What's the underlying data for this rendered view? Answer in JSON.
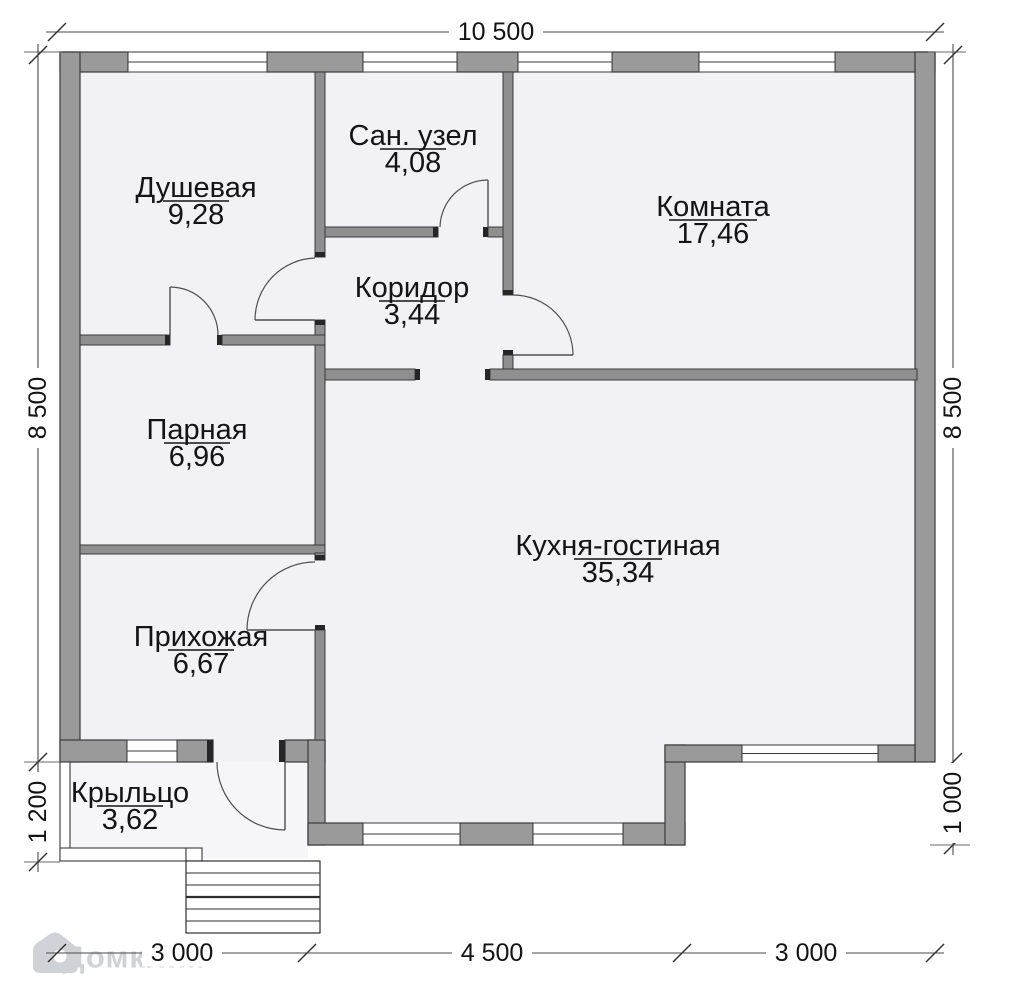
{
  "palette": {
    "background": "#ffffff",
    "room_fill": "#f1f1f6",
    "porch_fill": "#f6f6fa",
    "wall_ext_fill": "#9a9a9a",
    "wall_int_fill": "#8f8f8f",
    "wall_outline": "#3a3a3a",
    "cap_fill": "#262626",
    "door_line": "#4f4f4f",
    "dim_line": "#4a4a4a",
    "text_color": "#141414",
    "watermark_color": "#979da8"
  },
  "plan": {
    "footprint": [
      {
        "x": 60,
        "y": 52,
        "w": 875,
        "h": 710,
        "kind": "room"
      },
      {
        "x": 308,
        "y": 762,
        "w": 377,
        "h": 83,
        "kind": "room"
      },
      {
        "x": 62,
        "y": 762,
        "w": 246,
        "h": 96,
        "kind": "porch"
      }
    ],
    "walls_ext": [
      [
        60,
        52,
        68,
        20
      ],
      [
        267,
        52,
        96,
        20
      ],
      [
        457,
        52,
        61,
        20
      ],
      [
        612,
        52,
        87,
        20
      ],
      [
        835,
        52,
        100,
        20
      ],
      [
        60,
        52,
        20,
        710
      ],
      [
        915,
        52,
        20,
        710
      ],
      [
        60,
        740,
        67,
        22
      ],
      [
        177,
        740,
        36,
        22
      ],
      [
        285,
        740,
        40,
        22
      ],
      [
        308,
        740,
        17,
        105
      ],
      [
        308,
        823,
        55,
        22
      ],
      [
        460,
        823,
        73,
        22
      ],
      [
        623,
        823,
        62,
        22
      ],
      [
        665,
        745,
        20,
        100
      ],
      [
        665,
        745,
        77,
        17
      ],
      [
        878,
        745,
        37,
        17
      ]
    ],
    "walls_int": [
      [
        315,
        72,
        10,
        185
      ],
      [
        315,
        320,
        10,
        233
      ],
      [
        325,
        227,
        113,
        10
      ],
      [
        488,
        227,
        15,
        10
      ],
      [
        503,
        72,
        10,
        223
      ],
      [
        503,
        355,
        10,
        25
      ],
      [
        80,
        335,
        90,
        10
      ],
      [
        222,
        335,
        103,
        10
      ],
      [
        325,
        369,
        90,
        11
      ],
      [
        490,
        369,
        427,
        11
      ],
      [
        80,
        545,
        245,
        9
      ],
      [
        315,
        553,
        10,
        7
      ],
      [
        315,
        630,
        10,
        110
      ]
    ],
    "caps": [
      [
        415,
        369,
        5,
        11
      ],
      [
        485,
        369,
        5,
        11
      ],
      [
        433,
        227,
        5,
        10
      ],
      [
        483,
        227,
        5,
        10
      ],
      [
        165,
        335,
        5,
        10
      ],
      [
        217,
        335,
        5,
        10
      ],
      [
        315,
        252,
        10,
        5
      ],
      [
        315,
        320,
        10,
        5
      ],
      [
        503,
        290,
        10,
        5
      ],
      [
        503,
        350,
        10,
        5
      ],
      [
        315,
        555,
        10,
        5
      ],
      [
        315,
        625,
        10,
        5
      ],
      [
        207,
        740,
        6,
        22
      ],
      [
        279,
        740,
        6,
        22
      ]
    ],
    "windows": [
      {
        "id": "window-dushevaya",
        "x": 128,
        "y": 52,
        "w": 139,
        "h": 20
      },
      {
        "id": "window-san-uzel",
        "x": 363,
        "y": 52,
        "w": 94,
        "h": 20
      },
      {
        "id": "window-komnata-left",
        "x": 518,
        "y": 52,
        "w": 94,
        "h": 20
      },
      {
        "id": "window-komnata-right",
        "x": 699,
        "y": 52,
        "w": 136,
        "h": 20
      },
      {
        "id": "window-kuhnya-left",
        "x": 363,
        "y": 823,
        "w": 97,
        "h": 22
      },
      {
        "id": "window-kuhnya-right",
        "x": 533,
        "y": 823,
        "w": 90,
        "h": 22
      },
      {
        "id": "window-prihozhaya",
        "x": 127,
        "y": 740,
        "w": 50,
        "h": 22
      },
      {
        "id": "window-kuhnya-east",
        "x": 742,
        "y": 745,
        "w": 136,
        "h": 17
      }
    ],
    "doors": [
      {
        "id": "door-san-uzel",
        "leaf": [
          488,
          227,
          488,
          180
        ],
        "arc": "M488,180 A48,48 0 0 0 440,227"
      },
      {
        "id": "door-dushevaya",
        "leaf": [
          315,
          320,
          255,
          320
        ],
        "arc": "M315,258 A62,62 0 0 0 255,320"
      },
      {
        "id": "door-parnaya",
        "leaf": [
          170,
          335,
          170,
          287
        ],
        "arc": "M170,287 A48,48 0 0 1 218,335"
      },
      {
        "id": "door-komnata",
        "leaf": [
          513,
          355,
          573,
          355
        ],
        "arc": "M513,295 A60,60 0 0 1 573,355"
      },
      {
        "id": "door-kuhnya-prihozhaya",
        "leaf": [
          315,
          630,
          247,
          630
        ],
        "arc": "M315,562 A68,68 0 0 0 247,630"
      },
      {
        "id": "door-krylco",
        "leaf": [
          285,
          762,
          285,
          830
        ],
        "arc": "M217,762 A68,68 0 0 0 285,830"
      }
    ],
    "porch_parts": [
      [
        60,
        762,
        10,
        98
      ],
      [
        60,
        848,
        126,
        13
      ],
      [
        186,
        848,
        16,
        13
      ]
    ],
    "stairs": {
      "x": 186,
      "y": 861,
      "w": 134,
      "h": 72,
      "lines": [
        873,
        885,
        897,
        909,
        921
      ],
      "bold_line": 897
    },
    "guides": [
      [
        24,
        52,
        62,
        52
      ],
      [
        928,
        52,
        966,
        52
      ],
      [
        24,
        762,
        60,
        762
      ],
      [
        930,
        845,
        970,
        845
      ],
      [
        24,
        862,
        60,
        862
      ]
    ],
    "rooms": [
      {
        "id": "dushevaya",
        "name": "Душевая",
        "area": "9,28",
        "label": [
          196,
          188
        ]
      },
      {
        "id": "san-uzel",
        "name": "Сан. узел",
        "area": "4,08",
        "label": [
          413,
          136
        ]
      },
      {
        "id": "komnata",
        "name": "Комната",
        "area": "17,46",
        "label": [
          713,
          207
        ]
      },
      {
        "id": "koridor",
        "name": "Коридор",
        "area": "3,44",
        "label": [
          412,
          288
        ]
      },
      {
        "id": "parnaya",
        "name": "Парная",
        "area": "6,96",
        "label": [
          197,
          430
        ]
      },
      {
        "id": "kuhnya-gostinaya",
        "name": "Кухня-гостиная",
        "area": "35,34",
        "label": [
          618,
          546
        ]
      },
      {
        "id": "prihozhaya",
        "name": "Прихожая",
        "area": "6,67",
        "label": [
          201,
          637
        ]
      },
      {
        "id": "krylco",
        "name": "Крыльцо",
        "area": "3,62",
        "label": [
          130,
          793
        ]
      }
    ],
    "dimensions": [
      {
        "id": "dim-top-width",
        "label": "10 500",
        "line": [
          46,
          32,
          944,
          32
        ],
        "ticks": [
          [
            57,
            32
          ],
          [
            935,
            32
          ]
        ],
        "lp": [
          496,
          32
        ],
        "rot": 0
      },
      {
        "id": "dim-left-height",
        "label": "8 500",
        "line": [
          38,
          44,
          38,
          770
        ],
        "ticks": [
          [
            38,
            55
          ],
          [
            38,
            762
          ]
        ],
        "lp": [
          38,
          408
        ],
        "rot": -90
      },
      {
        "id": "dim-left-porch",
        "label": "1 200",
        "line": [
          38,
          762,
          38,
          872
        ],
        "ticks": [
          [
            38,
            862
          ]
        ],
        "lp": [
          38,
          812
        ],
        "rot": -90
      },
      {
        "id": "dim-right-height",
        "label": "8 500",
        "line": [
          953,
          44,
          953,
          770
        ],
        "ticks": [
          [
            953,
            55
          ],
          [
            953,
            762
          ]
        ],
        "lp": [
          953,
          408
        ],
        "rot": -90
      },
      {
        "id": "dim-right-step",
        "label": "1 000",
        "line": [
          953,
          762,
          953,
          855
        ],
        "ticks": [
          [
            953,
            845
          ]
        ],
        "lp": [
          953,
          803
        ],
        "rot": -90
      },
      {
        "id": "dim-bottom-left",
        "label": "3 000",
        "line": [
          46,
          953,
          307,
          953
        ],
        "ticks": [
          [
            57,
            953
          ],
          [
            307,
            953
          ]
        ],
        "lp": [
          182,
          953
        ],
        "rot": 0
      },
      {
        "id": "dim-bottom-mid",
        "label": "4 500",
        "line": [
          307,
          953,
          682,
          953
        ],
        "ticks": [
          [
            682,
            953
          ]
        ],
        "lp": [
          492,
          953
        ],
        "rot": 0
      },
      {
        "id": "dim-bottom-right",
        "label": "3 000",
        "line": [
          682,
          953,
          944,
          953
        ],
        "ticks": [
          [
            935,
            953
          ]
        ],
        "lp": [
          806,
          953
        ],
        "rot": 0
      }
    ],
    "watermark": {
      "text": "Домклик"
    }
  }
}
